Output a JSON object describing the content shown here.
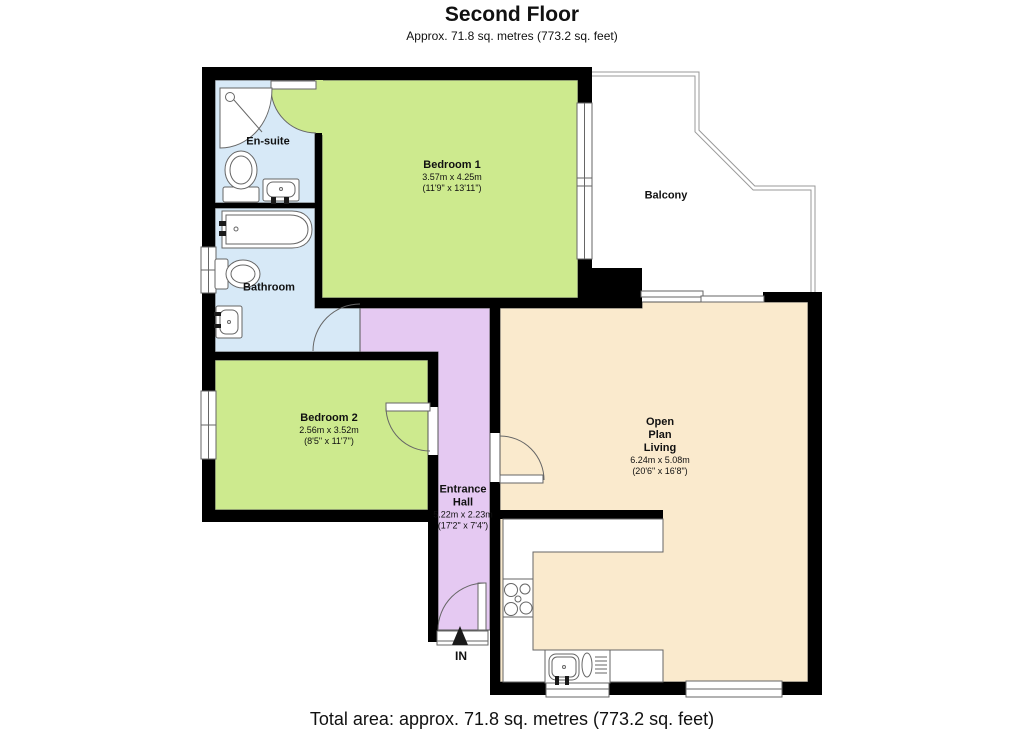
{
  "header": {
    "title": "Second Floor",
    "subtitle": "Approx. 71.8 sq. metres (773.2 sq. feet)"
  },
  "footer": {
    "total_area": "Total area: approx. 71.8 sq. metres (773.2 sq. feet)"
  },
  "rooms": {
    "ensuite": {
      "name": "En-suite"
    },
    "bathroom": {
      "name": "Bathroom"
    },
    "balcony": {
      "name": "Balcony"
    },
    "bedroom1": {
      "name": "Bedroom 1",
      "metric": "3.57m x 4.25m",
      "imperial": "(11'9\" x 13'11\")"
    },
    "bedroom2": {
      "name": "Bedroom 2",
      "metric": "2.56m x 3.52m",
      "imperial": "(8'5\" x 11'7\")"
    },
    "entrance_hall": {
      "line1": "Entrance",
      "line2": "Hall",
      "metric": "5.22m x 2.23m",
      "imperial": "(17'2\" x 7'4\")"
    },
    "open_plan_living": {
      "line1": "Open",
      "line2": "Plan",
      "line3": "Living",
      "metric": "6.24m x 5.08m",
      "imperial": "(20'6\" x 16'8\")"
    }
  },
  "entrance": {
    "in_label": "IN"
  },
  "colors": {
    "wall": "#000000",
    "bedroom_fill": "#cdea8e",
    "bathroom_fill": "#d7e9f7",
    "hall_fill": "#e5c9f2",
    "living_fill": "#faeacd"
  }
}
